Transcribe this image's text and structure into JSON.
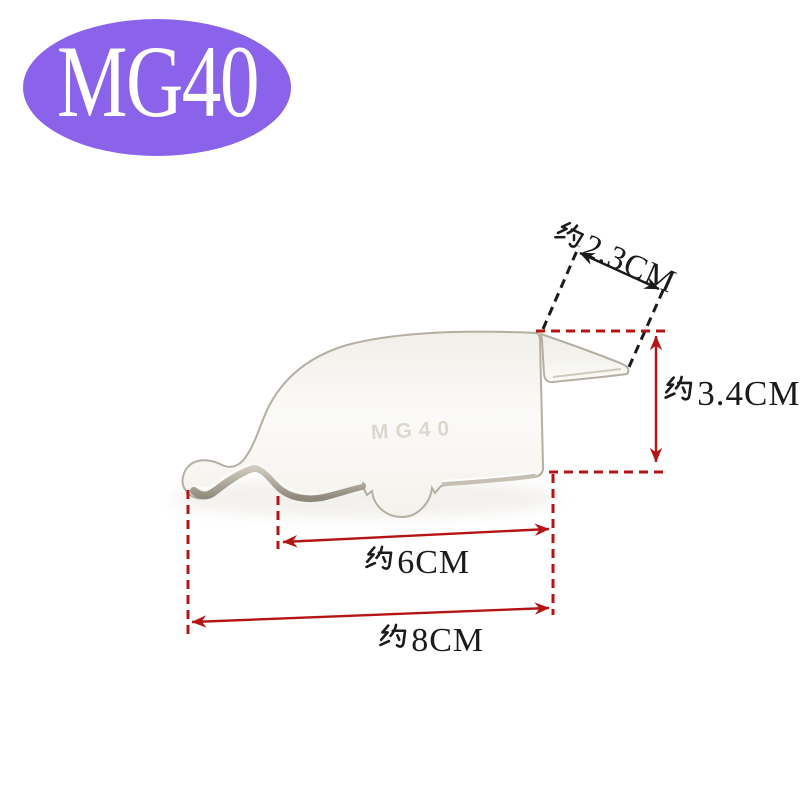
{
  "badge": {
    "label": "MG40"
  },
  "part": {
    "engraving": "MG40"
  },
  "dimensions": {
    "approx_prefix": "约",
    "items": [
      {
        "id": "flap-width",
        "label": "约2.3CM",
        "value": "2.3CM"
      },
      {
        "id": "side-height",
        "label": "约3.4CM",
        "value": "3.4CM"
      },
      {
        "id": "inner-width",
        "label": "约6CM",
        "value": "6CM"
      },
      {
        "id": "overall-width",
        "label": "约8CM",
        "value": "8CM"
      }
    ]
  },
  "colors": {
    "background": "#ffffff",
    "badge_purple": "#8b63ea",
    "badge_text": "#ffffff",
    "dimension_red": "#b51414",
    "dimension_black": "#1b1b1b",
    "metal_edge": "#b5afa3",
    "engraving_gray": "#dcd8cd"
  }
}
